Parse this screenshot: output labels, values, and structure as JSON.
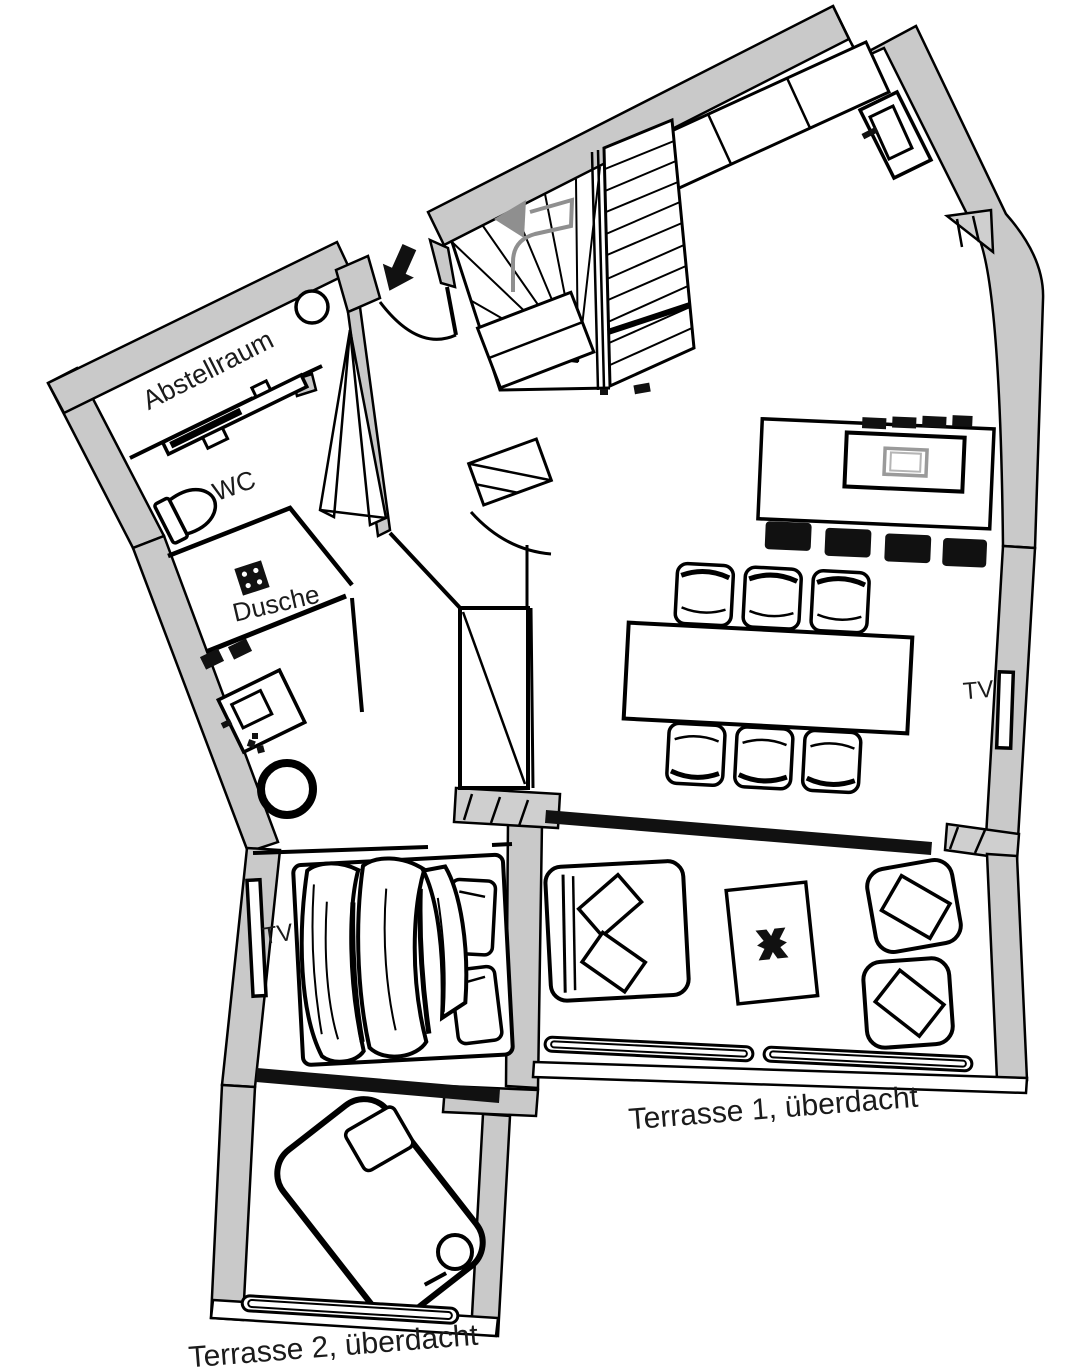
{
  "page": {
    "title": "Grundriss Wohnung",
    "background": "#ffffff"
  },
  "colors": {
    "wall_fill": "#c9c9c9",
    "line": "#000000",
    "glass_door": "#111111",
    "stair_guide_arrow": "#8f8f8f",
    "cooktop": "#9a9a9a"
  },
  "rooms": {
    "abstellraum": {
      "label": "Abstellraum"
    },
    "wc": {
      "label": "WC"
    },
    "dusche": {
      "label": "Dusche"
    },
    "wohnbereich": {
      "tv_label": "TV"
    },
    "schlafzimmer": {
      "tv_label": "TV"
    },
    "terrasse1": {
      "label": "Terrasse 1, überdacht"
    },
    "terrasse2": {
      "label": "Terrasse 2, überdacht"
    }
  },
  "icons": {
    "entry_arrow": "entry-direction-arrow",
    "stair_arrow": "stair-direction-arrow"
  }
}
